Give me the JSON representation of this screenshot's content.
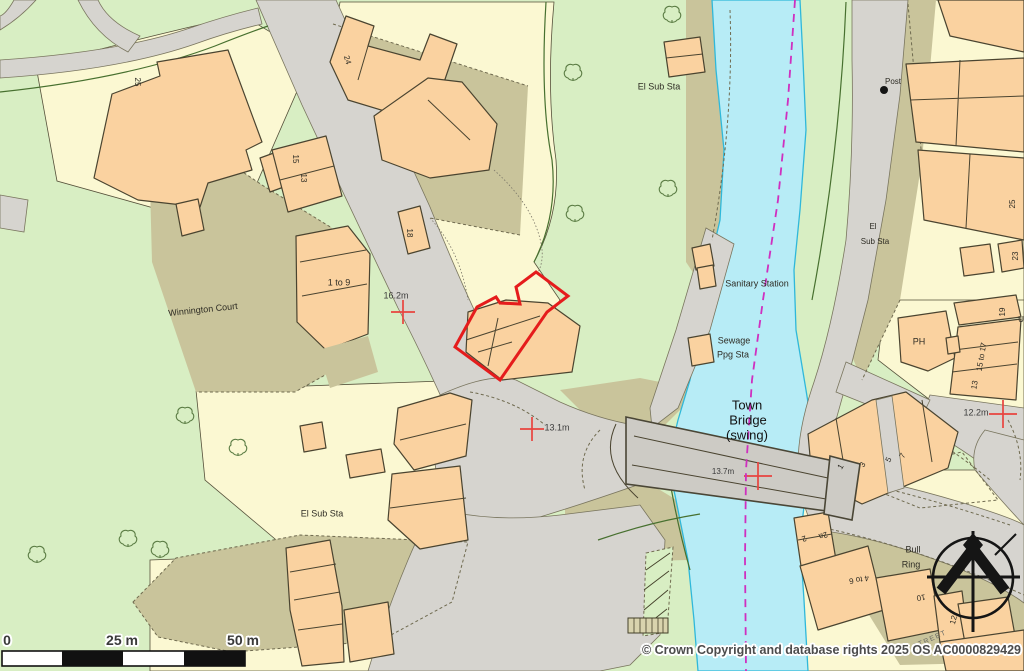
{
  "map_title": "Town Bridge (swing) location plan",
  "attribution": {
    "text": "© Crown Copyright and database rights 2025 OS AC0000829429"
  },
  "scale_bar": {
    "labels": [
      "0",
      "25 m",
      "50 m"
    ]
  },
  "colors": {
    "background_green": "#d8eec3",
    "plot_yellow": "#fbf8d2",
    "area_khaki": "#c9c49b",
    "building_orange": "#fad2a0",
    "road_gray": "#d6d4cf",
    "river_cyan": "#b7ecf6",
    "river_edge": "#2fb8da",
    "boundary_magenta": "#cf2fbf",
    "plot_outline_red": "#e51c1c",
    "cross_red": "#e8443f",
    "tree_green": "#5c7d45"
  },
  "icons": {
    "north_arrow": "compass-north-icon",
    "post_marker": "post-dot-icon",
    "benchmark": "red-cross-icon",
    "tree": "tree-icon"
  },
  "labels": [
    {
      "id": "winnington-court",
      "text": "Winnington Court",
      "x": 203,
      "y": 310,
      "size": 9,
      "rot": -6
    },
    {
      "id": "house-25",
      "text": "25",
      "x": 137,
      "y": 82,
      "size": 8,
      "rot": 90
    },
    {
      "id": "house-24",
      "text": "24",
      "x": 347,
      "y": 60,
      "size": 8,
      "rot": 75
    },
    {
      "id": "house-15",
      "text": "15",
      "x": 295,
      "y": 159,
      "size": 8,
      "rot": 90
    },
    {
      "id": "house-13",
      "text": "13",
      "x": 303,
      "y": 178,
      "size": 8,
      "rot": 90
    },
    {
      "id": "house-18",
      "text": "18",
      "x": 409,
      "y": 233,
      "size": 8,
      "rot": 90
    },
    {
      "id": "flats-1-to-9",
      "text": "1 to 9",
      "x": 339,
      "y": 283,
      "size": 9,
      "rot": 0
    },
    {
      "id": "spot-height-16-2",
      "text": "16.2m",
      "x": 396,
      "y": 296,
      "size": 9,
      "cls": "spot"
    },
    {
      "id": "el-sub-sta-top",
      "text": "El Sub Sta",
      "x": 659,
      "y": 87,
      "size": 9
    },
    {
      "id": "post",
      "text": "Post",
      "x": 893,
      "y": 82,
      "size": 8
    },
    {
      "id": "el-right-line1",
      "text": "El",
      "x": 873,
      "y": 227,
      "size": 8
    },
    {
      "id": "el-right-line2",
      "text": "Sub Sta",
      "x": 875,
      "y": 242,
      "size": 8
    },
    {
      "id": "sanitary-station",
      "text": "Sanitary Station",
      "x": 757,
      "y": 284,
      "size": 9
    },
    {
      "id": "sewage-line1",
      "text": "Sewage",
      "x": 734,
      "y": 341,
      "size": 9
    },
    {
      "id": "sewage-line2",
      "text": "Ppg Sta",
      "x": 733,
      "y": 355,
      "size": 9
    },
    {
      "id": "town-bridge-line1",
      "text": "Town",
      "x": 747,
      "y": 405,
      "size": 13,
      "cls": "big"
    },
    {
      "id": "town-bridge-line2",
      "text": "Bridge",
      "x": 748,
      "y": 420,
      "size": 13,
      "cls": "big"
    },
    {
      "id": "town-bridge-line3",
      "text": "(swing)",
      "x": 747,
      "y": 435,
      "size": 13,
      "cls": "big"
    },
    {
      "id": "spot-height-13-7",
      "text": "13.7m",
      "x": 723,
      "y": 472,
      "size": 8,
      "cls": "spot"
    },
    {
      "id": "spot-height-13-1",
      "text": "13.1m",
      "x": 557,
      "y": 428,
      "size": 9,
      "cls": "spot"
    },
    {
      "id": "ph",
      "text": "PH",
      "x": 919,
      "y": 342,
      "size": 9
    },
    {
      "id": "house-19",
      "text": "19",
      "x": 1003,
      "y": 312,
      "size": 8,
      "rot": -90
    },
    {
      "id": "house-15-to-17",
      "text": "15 to 17",
      "x": 982,
      "y": 357,
      "size": 8,
      "rot": -80
    },
    {
      "id": "house-13b",
      "text": "13",
      "x": 975,
      "y": 385,
      "size": 8,
      "rot": -80
    },
    {
      "id": "spot-height-12-2",
      "text": "12.2m",
      "x": 976,
      "y": 413,
      "size": 9,
      "cls": "spot"
    },
    {
      "id": "house-25b",
      "text": "25",
      "x": 1013,
      "y": 204,
      "size": 8,
      "rot": -90
    },
    {
      "id": "house-23",
      "text": "23",
      "x": 1016,
      "y": 256,
      "size": 8,
      "rot": -90
    },
    {
      "id": "house-1",
      "text": "1",
      "x": 841,
      "y": 467,
      "size": 8,
      "rot": -60
    },
    {
      "id": "house-3",
      "text": "3",
      "x": 863,
      "y": 465,
      "size": 8,
      "rot": -60
    },
    {
      "id": "house-5",
      "text": "5",
      "x": 889,
      "y": 460,
      "size": 8,
      "rot": -60
    },
    {
      "id": "house-7",
      "text": "7",
      "x": 903,
      "y": 456,
      "size": 8,
      "rot": -60
    },
    {
      "id": "house-2",
      "text": "2",
      "x": 804,
      "y": 538,
      "size": 8,
      "rot": 160
    },
    {
      "id": "house-2a",
      "text": "2a",
      "x": 823,
      "y": 535,
      "size": 8,
      "rot": 160
    },
    {
      "id": "house-4-to-6",
      "text": "4 to 6",
      "x": 859,
      "y": 579,
      "size": 8,
      "rot": 170
    },
    {
      "id": "house-10",
      "text": "10",
      "x": 921,
      "y": 597,
      "size": 8,
      "rot": 170
    },
    {
      "id": "house-12",
      "text": "12",
      "x": 954,
      "y": 620,
      "size": 8,
      "rot": -75
    },
    {
      "id": "bull-ring-line1",
      "text": "Bull",
      "x": 913,
      "y": 550,
      "size": 9
    },
    {
      "id": "bull-ring-line2",
      "text": "Ring",
      "x": 911,
      "y": 565,
      "size": 9
    },
    {
      "id": "el-sub-sta-bottom",
      "text": "El Sub Sta",
      "x": 322,
      "y": 514,
      "size": 9
    },
    {
      "id": "street-partial",
      "text": "STREET",
      "x": 930,
      "y": 640,
      "size": 7,
      "rot": -24,
      "cls": "street"
    },
    {
      "id": "street-partial-u",
      "text": "U",
      "x": 1021,
      "y": 320,
      "size": 8
    }
  ]
}
